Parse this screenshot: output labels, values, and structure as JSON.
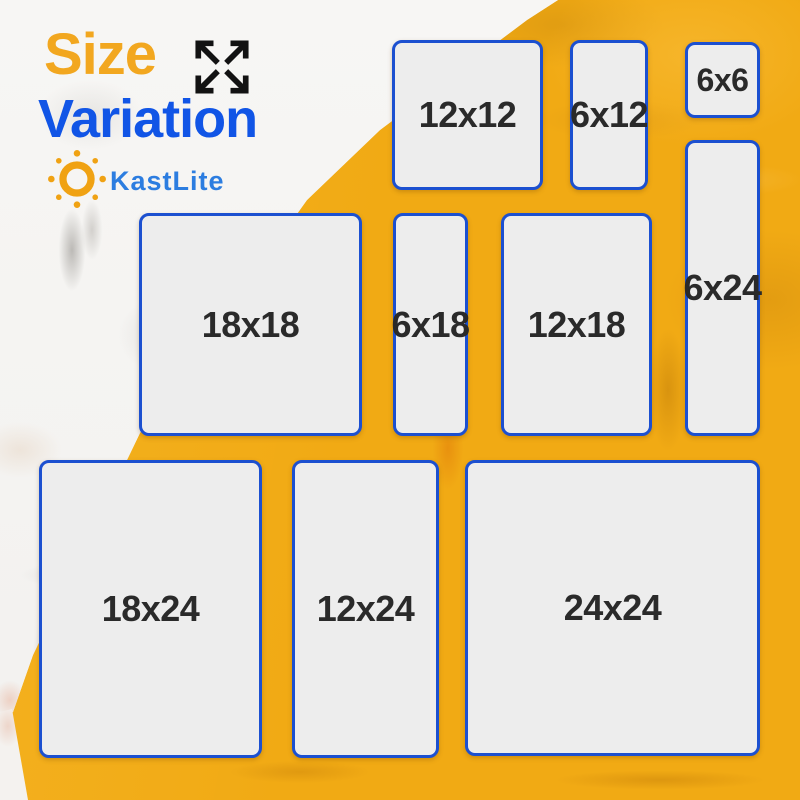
{
  "header": {
    "title_word1": "Size",
    "title_word2": "Variation",
    "brand_name": "KastLite"
  },
  "sizes": {
    "items": [
      {
        "label": "12x12"
      },
      {
        "label": "6x12"
      },
      {
        "label": "6x6"
      },
      {
        "label": "6x24"
      },
      {
        "label": "18x18"
      },
      {
        "label": "6x18"
      },
      {
        "label": "12x18"
      },
      {
        "label": "18x24"
      },
      {
        "label": "12x24"
      },
      {
        "label": "24x24"
      }
    ]
  },
  "icons": {
    "expand_arrows": "four diagonal arrows pointing outward",
    "sun_logo": "orange sun ring with eight ray dots"
  },
  "colors": {
    "title_orange": "#F2A71F",
    "title_blue": "#1155E6",
    "brand_blue": "#2C7DE0",
    "box_border_blue": "#1C50D0",
    "box_fill_gray": "#EDEDED",
    "label_text": "#2A2A2A",
    "background_yellow": "#F1AA14",
    "background_white": "#F6F5F3",
    "arrow_icon_black": "#121212",
    "sun_orange": "#F0A213"
  }
}
